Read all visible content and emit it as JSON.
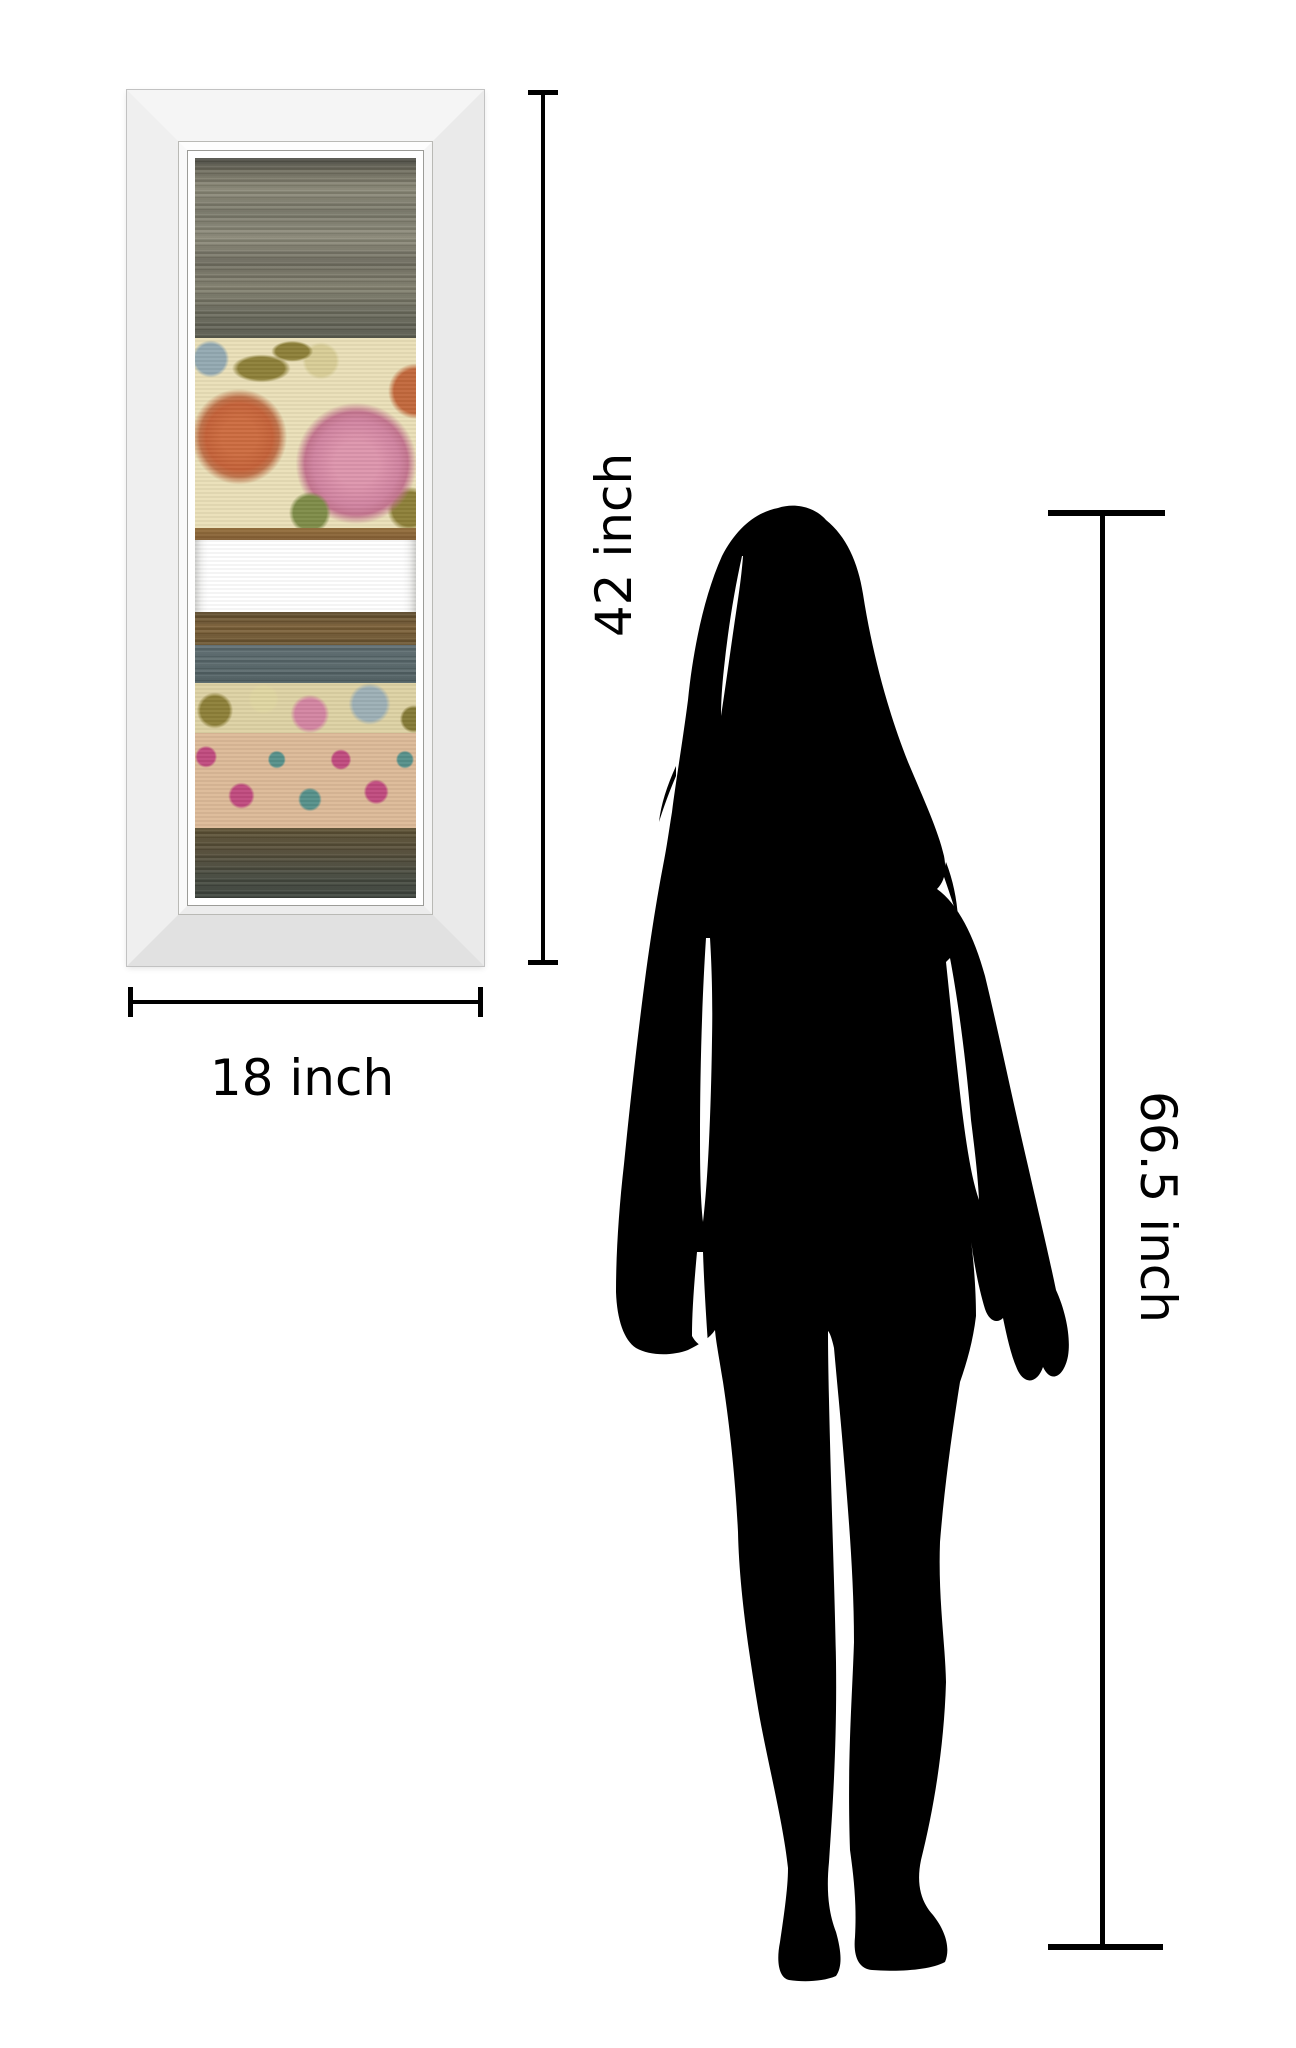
{
  "scene": {
    "background": "#ffffff",
    "description": "Product size-comparison graphic: mirror-framed striped floral wall-art panel beside a standing woman silhouette with dimension lines"
  },
  "artwork": {
    "name": "mirror-framed striped floral panel",
    "frame_color": "#efefef",
    "bands": [
      {
        "name": "taupe-streak-band",
        "color": "#7f7d6d"
      },
      {
        "name": "floral-mums-band",
        "color": "#eae0b8",
        "accents": [
          "#c46138",
          "#d083a0",
          "#8d8038",
          "#93a9b2"
        ]
      },
      {
        "name": "rust-stripe",
        "color": "#8a6236"
      },
      {
        "name": "blue-gray-band",
        "color": "#5c6b70"
      },
      {
        "name": "brown-stripe-band",
        "color": "#6f5833"
      },
      {
        "name": "blue-gray-band-2",
        "color": "#586growth"
      },
      {
        "name": "floral-mums-band-2",
        "color": "#ded2a4"
      },
      {
        "name": "damask-band",
        "color": "#dcba98",
        "accents": [
          "#c04a7e",
          "#56908a"
        ]
      },
      {
        "name": "dark-olive-band",
        "color": "#4c4b3c"
      }
    ]
  },
  "dimension_labels": {
    "art_height": "42 inch",
    "art_width": "18 inch",
    "person_height": "66.5 inch"
  },
  "silhouette": {
    "name": "standing-woman-silhouette",
    "color": "#000000"
  },
  "dimension_line_color": "#000000"
}
